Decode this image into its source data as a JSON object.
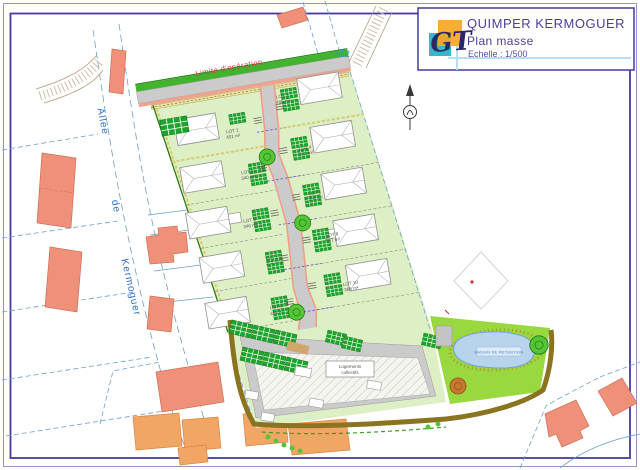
{
  "title_block": {
    "project": "QUIMPER KERMOGUER",
    "drawing": "Plan masse",
    "scale": "Echelle : 1/500",
    "logo": "GT"
  },
  "annotations": {
    "operation_limit": "Limite d'opération",
    "street": {
      "w1": "Allée",
      "w2": "de",
      "w3": "Kermoguer"
    },
    "parcel_number": "452",
    "pond_label": "BASSIN DE RETENTION",
    "building_label_line1": "Logements",
    "building_label_line2": "collectifs"
  },
  "lots": [
    {
      "name": "LOT 1",
      "area": "401 m²"
    },
    {
      "name": "LOT 2",
      "area": "486 m²"
    },
    {
      "name": "LOT 3",
      "area": "340 m²"
    },
    {
      "name": "LOT 4",
      "area": "342 m²"
    },
    {
      "name": "LOT 5",
      "area": "346 m²"
    },
    {
      "name": "LOT 6",
      "area": "350 m²"
    },
    {
      "name": "LOT 7",
      "area": "364 m²"
    },
    {
      "name": "LOT 8",
      "area": "387 m²"
    },
    {
      "name": "LOT 9",
      "area": "353 m²"
    },
    {
      "name": "LOT 10",
      "area": "365 m²"
    }
  ],
  "colors": {
    "frame_purple": "#443a9e",
    "title_text": "#4b3e9e",
    "accent_light_blue": "#b3e0f5",
    "logo_orange": "#f6a720",
    "logo_teal": "#35b8c8",
    "estate_green": "#ddefc4",
    "lawn_green": "#9ad83f",
    "verge_green": "#41b32c",
    "road_gray": "#cbcbcb",
    "curb_salmon": "#f0a28c",
    "existing_building_salmon": "#ef9079",
    "existing_building_orange": "#f2a665",
    "hedge_green": "#1ea32c",
    "pond_blue": "#b8d4ec",
    "boundary_brown": "#8a741f",
    "parcel_line_blue": "#6aa0d0",
    "limit_red": "#e03535"
  }
}
